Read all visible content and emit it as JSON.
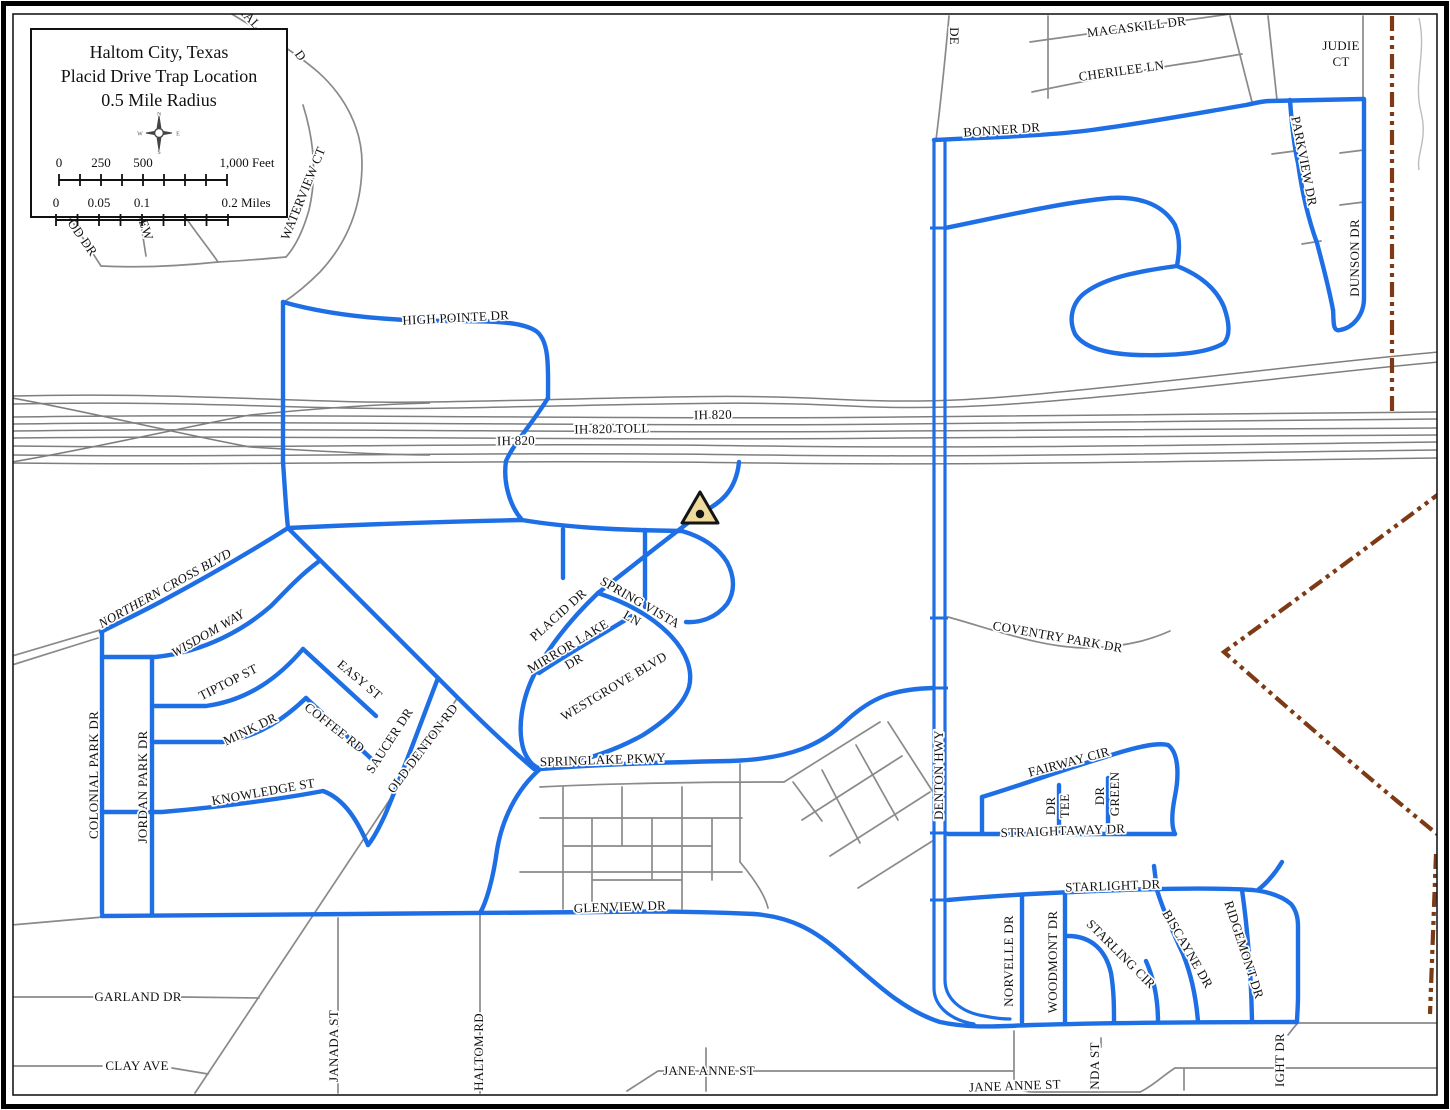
{
  "map": {
    "title_box": {
      "line1": "Haltom City, Texas",
      "line2": "Placid Drive Trap Location",
      "line3": "0.5 Mile Radius"
    },
    "compass": {
      "n": "N",
      "e": "E",
      "s": "S",
      "w": "W"
    },
    "scale_feet": {
      "t0": "0",
      "t1": "250",
      "t2": "500",
      "t3": "1,000 Feet"
    },
    "scale_miles": {
      "t0": "0",
      "t1": "0.05",
      "t2": "0.1",
      "t3": "0.2 Miles"
    },
    "colors": {
      "highlight_blue": "#1E6FE6",
      "road_gray": "#8A8A8A",
      "freeway_gray": "#7E7E7E",
      "boundary_brown": "#7D3A14",
      "marker_fill": "#EFDA9C",
      "marker_outline": "#141414"
    },
    "marker": {
      "label": "trap-location",
      "x": 700,
      "y": 513
    },
    "street_labels": [
      {
        "t": "HAL",
        "x": 246,
        "y": 20,
        "r": 46
      },
      {
        "t": "D",
        "x": 297,
        "y": 58,
        "r": 55
      },
      {
        "t": "OD DR",
        "x": 79,
        "y": 240,
        "r": 55
      },
      {
        "t": "EW",
        "x": 142,
        "y": 231,
        "r": 72
      },
      {
        "t": "WATERVIEW CT",
        "x": 307,
        "y": 195,
        "r": -68
      },
      {
        "t": "HIGH POINTE DR",
        "x": 456,
        "y": 322,
        "r": -3
      },
      {
        "t": "IH 820",
        "x": 713,
        "y": 419,
        "r": -1
      },
      {
        "t": "IH 820 TOLL",
        "x": 612,
        "y": 433,
        "r": -1
      },
      {
        "t": "IH 820",
        "x": 516,
        "y": 445,
        "r": -1
      },
      {
        "t": "DE",
        "x": 950,
        "y": 36,
        "r": 90
      },
      {
        "t": "MACASKILL DR",
        "x": 1137,
        "y": 31,
        "r": -7
      },
      {
        "t": "CHERILEE LN",
        "x": 1122,
        "y": 75,
        "r": -8
      },
      {
        "t": "JUDIE",
        "x": 1341,
        "y": 50,
        "r": 0
      },
      {
        "t": "CT",
        "x": 1341,
        "y": 66,
        "r": 0
      },
      {
        "t": "BONNER DR",
        "x": 1002,
        "y": 134,
        "r": -4
      },
      {
        "t": "PARKVIEW DR",
        "x": 1300,
        "y": 162,
        "r": 79
      },
      {
        "t": "DUNSON DR",
        "x": 1359,
        "y": 258,
        "r": -90
      },
      {
        "t": "NORTHERN CROSS BLVD",
        "x": 167,
        "y": 592,
        "r": -29,
        "it": 1
      },
      {
        "t": "WISDOM WAY",
        "x": 210,
        "y": 637,
        "r": -30,
        "it": 1
      },
      {
        "t": "TIPTOP ST",
        "x": 230,
        "y": 686,
        "r": -27
      },
      {
        "t": "EASY ST",
        "x": 357,
        "y": 683,
        "r": 40
      },
      {
        "t": "MINK DR",
        "x": 252,
        "y": 733,
        "r": -26
      },
      {
        "t": "COFFEE RD",
        "x": 332,
        "y": 731,
        "r": 38
      },
      {
        "t": "SAUCER DR",
        "x": 393,
        "y": 743,
        "r": -57
      },
      {
        "t": "OLD DENTON RD",
        "x": 426,
        "y": 751,
        "r": -53
      },
      {
        "t": "KNOWLEDGE ST",
        "x": 264,
        "y": 796,
        "r": -10
      },
      {
        "t": "COLONIAL PARK DR",
        "x": 98,
        "y": 775,
        "r": -90
      },
      {
        "t": "JORDAN PARK DR",
        "x": 147,
        "y": 787,
        "r": -90
      },
      {
        "t": "PLACID DR",
        "x": 561,
        "y": 618,
        "r": -42
      },
      {
        "t": "SPRING VISTA",
        "x": 638,
        "y": 606,
        "r": 30
      },
      {
        "t": "LN",
        "x": 630,
        "y": 622,
        "r": 30
      },
      {
        "t": "MIRROR LAKE",
        "x": 570,
        "y": 650,
        "r": -31
      },
      {
        "t": "DR",
        "x": 576,
        "y": 665,
        "r": -31
      },
      {
        "t": "WESTGROVE BLVD",
        "x": 616,
        "y": 690,
        "r": -31
      },
      {
        "t": "SPRINGLAKE PKWY",
        "x": 603,
        "y": 764,
        "r": -2
      },
      {
        "t": "COVENTRY PARK DR",
        "x": 1057,
        "y": 641,
        "r": 10
      },
      {
        "t": "DENTON HWY",
        "x": 943,
        "y": 775,
        "r": -90
      },
      {
        "t": "FAIRWAY CIR",
        "x": 1070,
        "y": 766,
        "r": -15
      },
      {
        "t": "TEE",
        "x": 1069,
        "y": 806,
        "r": -90
      },
      {
        "t": "DR",
        "x": 1055,
        "y": 806,
        "r": -90
      },
      {
        "t": "GREEN",
        "x": 1119,
        "y": 794,
        "r": -90
      },
      {
        "t": "DR",
        "x": 1104,
        "y": 796,
        "r": -90
      },
      {
        "t": "STRAIGHTAWAY DR",
        "x": 1063,
        "y": 835,
        "r": -2
      },
      {
        "t": "STARLIGHT DR",
        "x": 1113,
        "y": 890,
        "r": -2
      },
      {
        "t": "NORVELLE DR",
        "x": 1013,
        "y": 961,
        "r": -90
      },
      {
        "t": "WOODMONT DR",
        "x": 1057,
        "y": 962,
        "r": -90
      },
      {
        "t": "STARLING CIR",
        "x": 1118,
        "y": 957,
        "r": 45
      },
      {
        "t": "BISCAYNE DR",
        "x": 1184,
        "y": 951,
        "r": 60
      },
      {
        "t": "RIDGEMONT DR",
        "x": 1240,
        "y": 951,
        "r": 72
      },
      {
        "t": "GLENVIEW DR",
        "x": 620,
        "y": 911,
        "r": -2
      },
      {
        "t": "GARLAND DR",
        "x": 138,
        "y": 1001,
        "r": 0
      },
      {
        "t": "JANADA ST",
        "x": 338,
        "y": 1046,
        "r": -90
      },
      {
        "t": "HALTOM RD",
        "x": 483,
        "y": 1052,
        "r": -90
      },
      {
        "t": "CLAY AVE",
        "x": 137,
        "y": 1070,
        "r": 0
      },
      {
        "t": "JANE ANNE ST",
        "x": 709,
        "y": 1075,
        "r": 0
      },
      {
        "t": "JANE ANNE ST",
        "x": 1015,
        "y": 1090,
        "r": -2
      },
      {
        "t": "NDA ST",
        "x": 1099,
        "y": 1066,
        "r": -90
      },
      {
        "t": "IGHT DR",
        "x": 1284,
        "y": 1060,
        "r": -90
      }
    ]
  }
}
